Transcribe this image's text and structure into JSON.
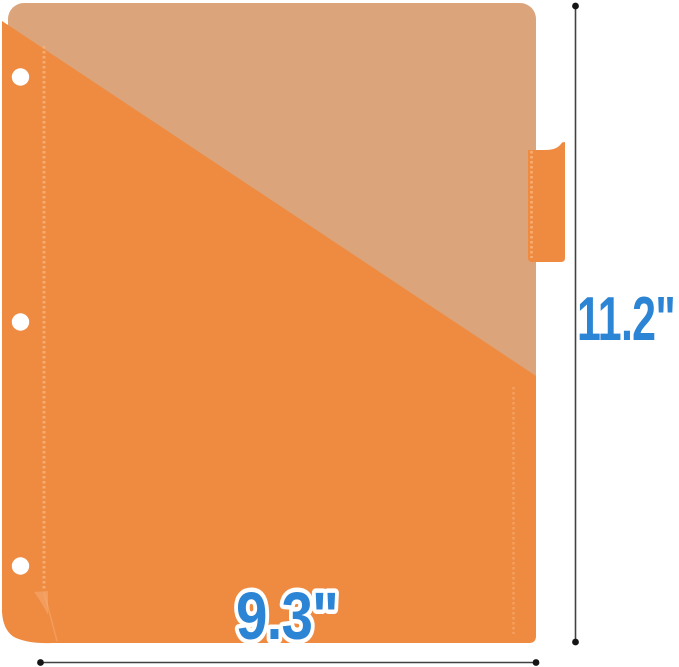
{
  "figure": {
    "height_dimension": {
      "label": "11.2\""
    },
    "width_dimension": {
      "label": "9.3\""
    }
  },
  "colors": {
    "background": "#ffffff",
    "sheet_tan": "#DBA47A",
    "pocket_orange": "#EE8B41",
    "tab_orange": "#EF8B41",
    "stitch_light": "#F8AF73",
    "stitch_right": "#F5A362",
    "curl_highlight": "#F6AD74",
    "hole_white": "#ffffff",
    "dimension_line": "#414141",
    "dimension_dot": "#161616",
    "label_blue": "#2C84D4",
    "label_outline": "#ffffff"
  }
}
